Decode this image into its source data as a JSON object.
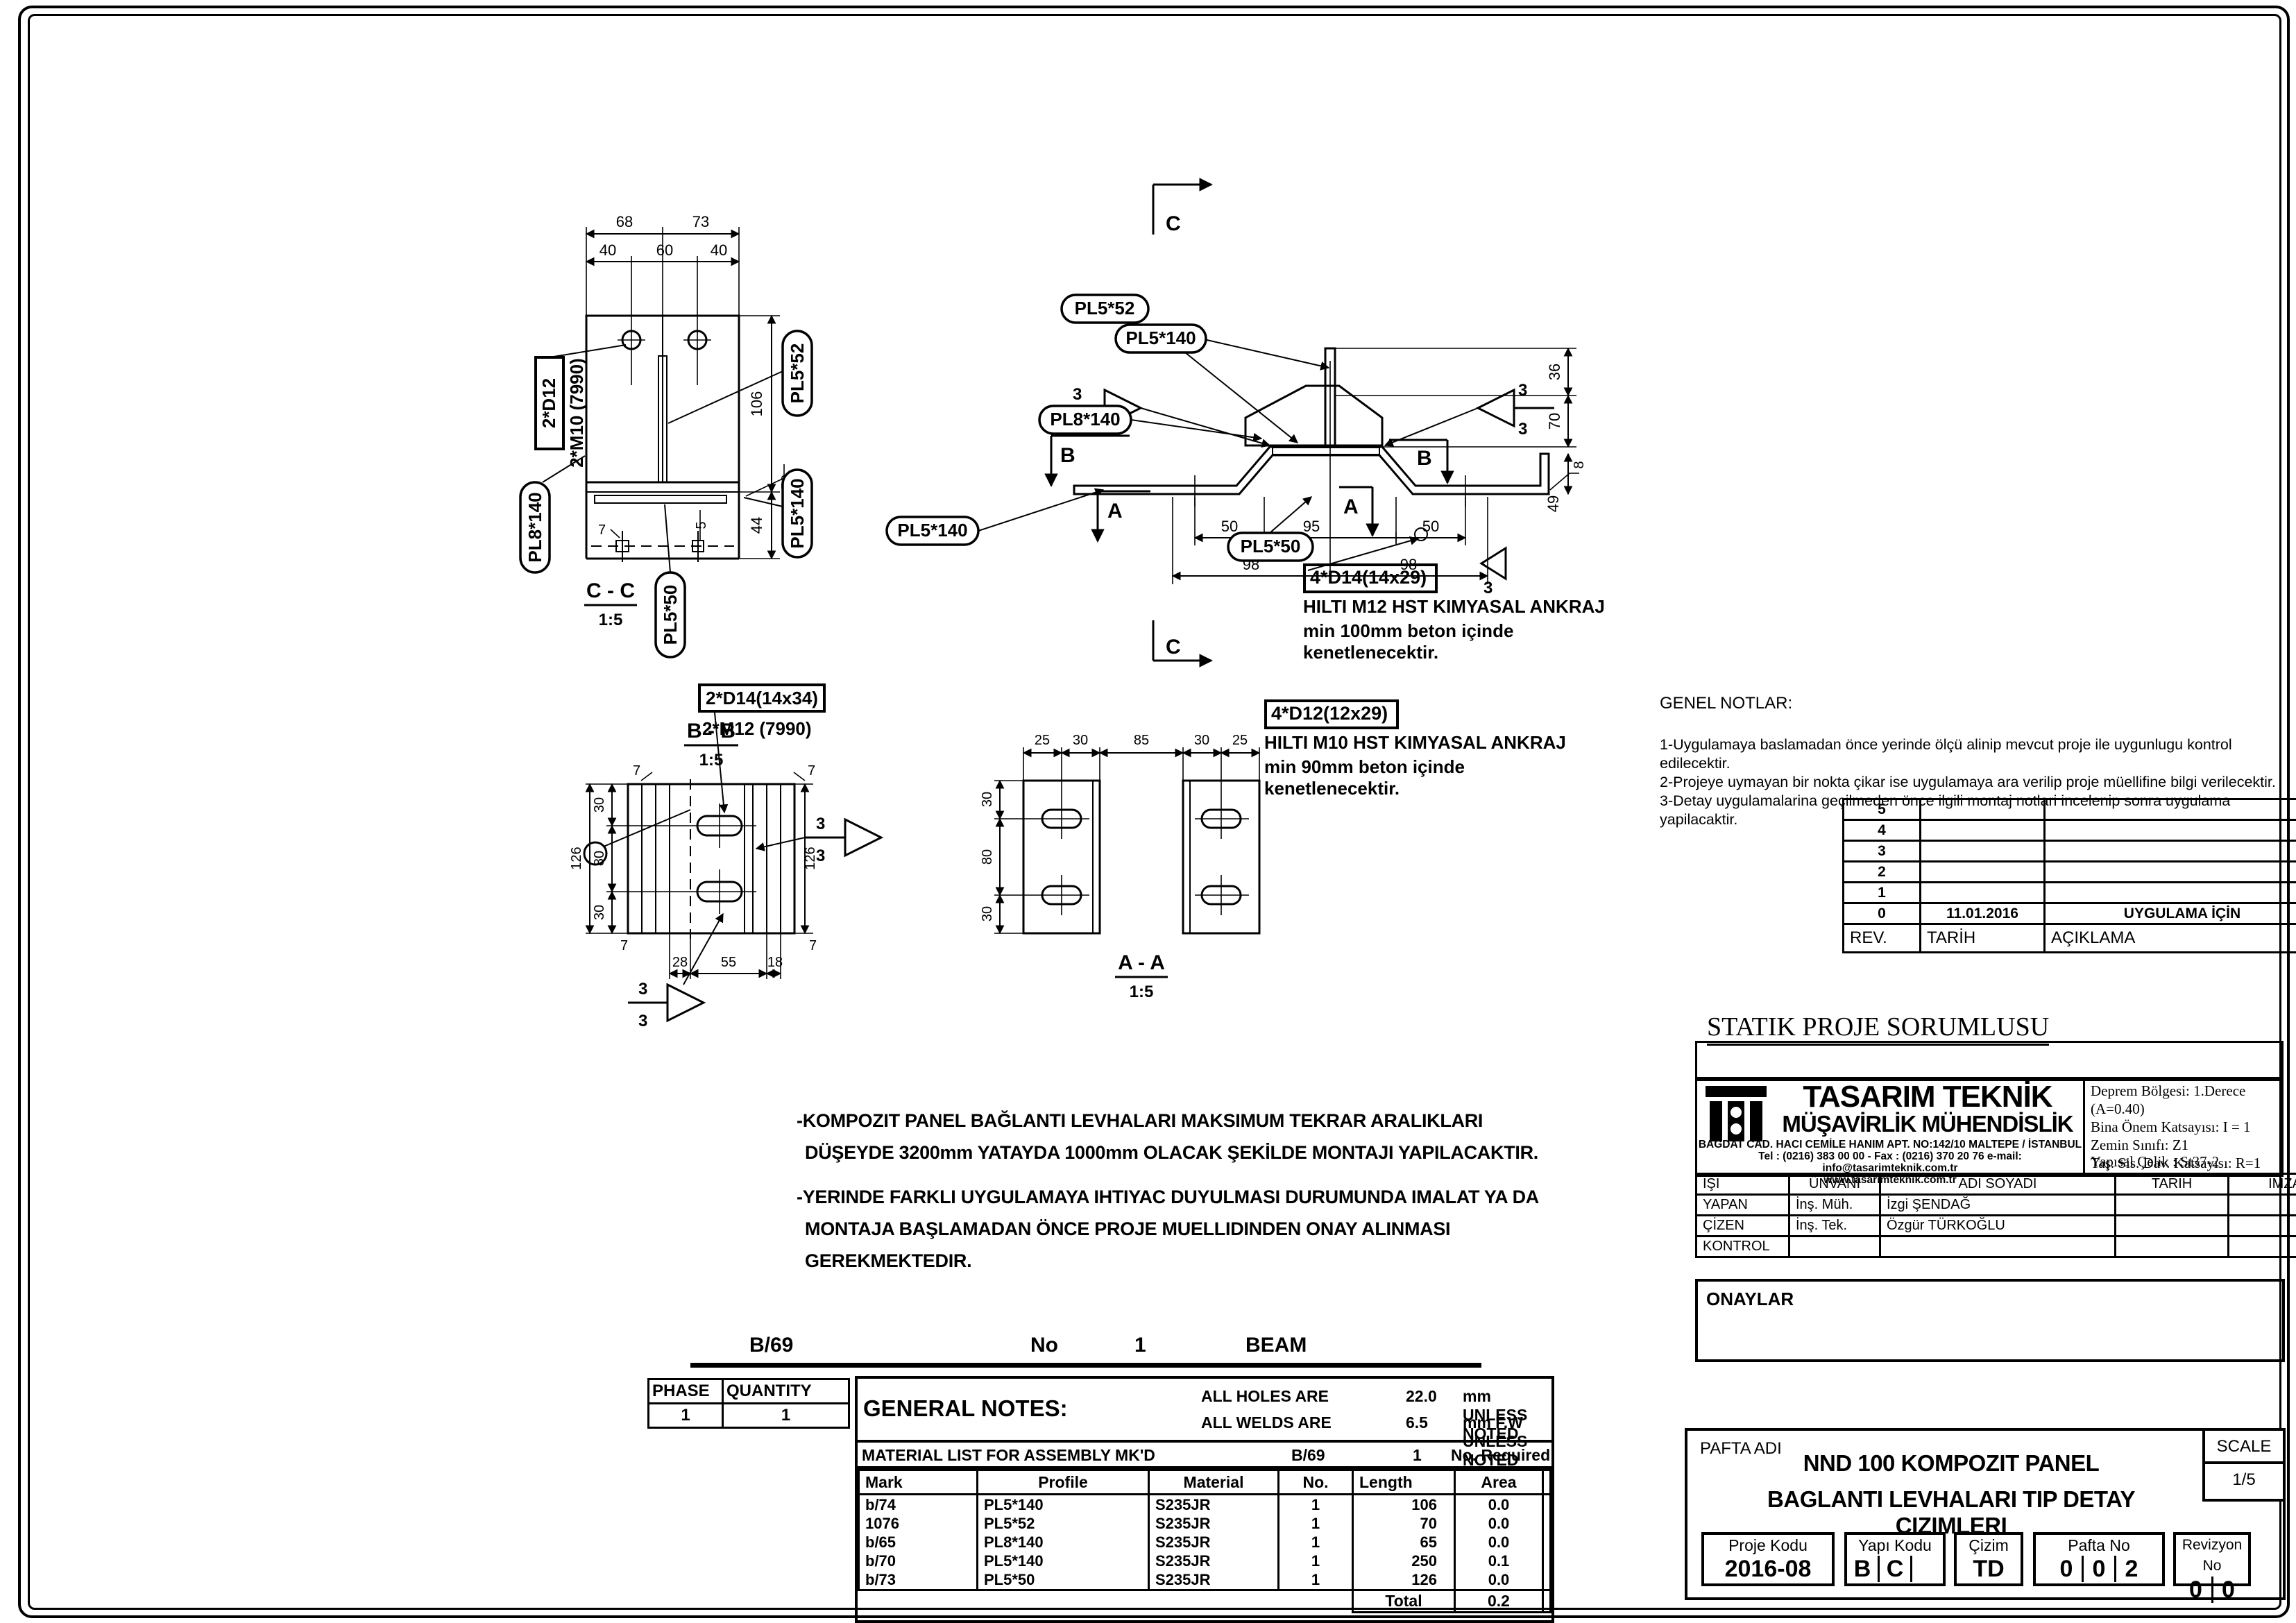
{
  "drawings": {
    "cc": {
      "title": "C - C",
      "scale": "1:5",
      "labels": {
        "bolt_box": "2*D12",
        "bolt_sub": "2*M10 (7990)",
        "pl552": "PL5*52",
        "pl8140": "PL8*140",
        "pl5140": "PL5*140",
        "pl550": "PL5*50"
      },
      "dims": {
        "d68": "68",
        "d73": "73",
        "d40a": "40",
        "d60": "60",
        "d40b": "40",
        "d106": "106",
        "d58": "58",
        "d44": "44",
        "d5": "5",
        "d7": "7"
      }
    },
    "elevation": {
      "labels": {
        "pl552": "PL5*52",
        "pl5140_top": "PL5*140",
        "pl8140": "PL8*140",
        "pl5140_left": "PL5*140",
        "pl550": "PL5*50"
      },
      "dims": {
        "d36": "36",
        "d70": "70",
        "d8": "8",
        "d49": "49",
        "d50a": "50",
        "d95": "95",
        "d50b": "50",
        "d98a": "98",
        "d98b": "98"
      },
      "weld": "3",
      "sections": {
        "c": "C",
        "b": "B",
        "a": "A"
      },
      "anchor": {
        "box": "4*D14(14x29)",
        "line1": "HILTI M12 HST KIMYASAL ANKRAJ",
        "line2": "min 100mm beton içinde kenetlenecektir."
      }
    },
    "bb": {
      "title": "B - B",
      "scale": "1:5",
      "label_box": "2*D14(14x34)",
      "label_sub": "2*M12 (7990)",
      "weld": "3",
      "dims": {
        "d7a": "7",
        "d7b": "7",
        "d7c": "7",
        "d7d": "7",
        "d30a": "30",
        "d80": "80",
        "d30b": "30",
        "d126a": "126",
        "d126b": "126",
        "d28": "28",
        "d55": "55",
        "d18": "18"
      }
    },
    "aa": {
      "title": "A - A",
      "scale": "1:5",
      "dims": {
        "d25a": "25",
        "d30a": "30",
        "d85": "85",
        "d30b": "30",
        "d25b": "25",
        "v30a": "30",
        "v80": "80",
        "v30b": "30"
      },
      "anchor": {
        "box": "4*D12(12x29)",
        "line1": "HILTI M10 HST KIMYASAL ANKRAJ",
        "line2": "min 90mm beton içinde kenetlenecektir."
      }
    }
  },
  "montaj_notes": {
    "p1l1": "-KOMPOZIT PANEL BAĞLANTI  LEVHALARI MAKSIMUM TEKRAR ARALIKLARI",
    "p1l2": "DÜŞEYDE 3200mm YATAYDA 1000mm OLACAK ŞEKİLDE MONTAJI YAPILACAKTIR.",
    "p2l1": "-YERINDE FARKLI UYGULAMAYA IHTIYAC DUYULMASI DURUMUNDA IMALAT YA DA",
    "p2l2": "MONTAJA BAŞLAMADAN ÖNCE PROJE MUELLIDINDEN ONAY ALINMASI GEREKMEKTEDIR."
  },
  "genel_notlar": {
    "title": "GENEL NOTLAR:",
    "items": [
      "1-Uygulamaya baslamadan önce yerinde ölçü alinip mevcut proje ile uygunlugu kontrol edilecektir.",
      "2-Projeye uymayan bir  nokta çikar ise uygulamaya ara verilip proje müellifine bilgi verilecektir.",
      "3-Detay uygulamalarina geçilmeden önce ilgili montaj notlari incelenip sonra uygulama yapilacaktir."
    ]
  },
  "revision": {
    "headers": [
      "REV.",
      "TARİH",
      "AÇIKLAMA"
    ],
    "rows": [
      [
        "5",
        "",
        ""
      ],
      [
        "4",
        "",
        ""
      ],
      [
        "3",
        "",
        ""
      ],
      [
        "2",
        "",
        ""
      ],
      [
        "1",
        "",
        ""
      ],
      [
        "0",
        "11.01.2016",
        "UYGULAMA İÇİN"
      ]
    ]
  },
  "statik_title": "STATIK PROJE SORUMLUSU",
  "company": {
    "name1": "TASARIM TEKNİK",
    "name2": "MÜŞAVİRLİK MÜHENDİSLİK",
    "address": "BAĞDAT CAD. HACI CEMİLE HANIM APT. NO:142/10   MALTEPE / İSTANBUL",
    "tel": "Tel : (0216) 383 00 00 - Fax : (0216) 370 20 76  e-mail: info@tasarimteknik.com.tr",
    "web": "www.tasarimteknik.com.tr"
  },
  "seismic": {
    "l1": "Deprem Bölgesi: 1.Derece (A=0.40)",
    "l2": "Bina Önem Katsayısı: I = 1",
    "l3": "Zemin Sınıfı: Z1",
    "l4": "Taş. Sis. Dav. Katsayısı: R=1",
    "l5": "Yapısal Çelik : St37-2"
  },
  "sign_table": {
    "headers": [
      "İŞİ",
      "ÜNVANI",
      "ADI SOYADI",
      "TARİH",
      "İMZA"
    ],
    "rows": [
      [
        "YAPAN",
        "İnş. Müh.",
        "İzgi ŞENDAĞ",
        "",
        ""
      ],
      [
        "ÇİZEN",
        "İnş. Tek.",
        "Özgür TÜRKOĞLU",
        "",
        ""
      ],
      [
        "KONTROL",
        "",
        "",
        "",
        ""
      ]
    ]
  },
  "onaylar": "ONAYLAR",
  "pafta": {
    "label": "PAFTA ADI",
    "title1": "NND 100 KOMPOZIT PANEL",
    "title2": "BAGLANTI LEVHALARI TIP DETAY CIZIMLERI",
    "scale_label": "SCALE",
    "scale_value": "1/5",
    "proje_kodu": {
      "label": "Proje Kodu",
      "value": "2016-08"
    },
    "yapi_kodu": {
      "label": "Yapı Kodu",
      "c1": "B",
      "c2": "C",
      "c3": ""
    },
    "cizim": {
      "label": "Çizim",
      "value": "TD"
    },
    "pafta_no": {
      "label": "Pafta No",
      "c1": "0",
      "c2": "0",
      "c3": "2"
    },
    "revizyon_no": {
      "label": "Revizyon No",
      "c1": "0",
      "c2": "0"
    }
  },
  "assembly": {
    "mark": "B/69",
    "no_label": "No",
    "no_value": "1",
    "type": "BEAM"
  },
  "phase_table": {
    "h1": "PHASE",
    "h2": "QUANTITY",
    "v1": "1",
    "v2": "1"
  },
  "general_notes": {
    "title": "GENERAL NOTES:",
    "holes_label": "ALL HOLES ARE",
    "holes_value": "22.0",
    "holes_unit": "mm UNLESS NOTED",
    "welds_label": "ALL WELDS ARE",
    "welds_value": "6.5",
    "welds_unit": "mm F.W UNLESS NOTED"
  },
  "material_list": {
    "caption": "MATERIAL LIST FOR ASSEMBLY MK'D",
    "assembly": "B/69",
    "req_value": "1",
    "req_label": "No. Required",
    "headers": [
      "Mark",
      "Profile",
      "Material",
      "No.",
      "Length",
      "Area",
      "Weight"
    ],
    "rows": [
      [
        "b/74",
        "PL5*140",
        "S235JR",
        "1",
        "106",
        "0.0",
        "0.6"
      ],
      [
        "1076",
        "PL5*52",
        "S235JR",
        "1",
        "70",
        "0.0",
        "0.1"
      ],
      [
        "b/65",
        "PL8*140",
        "S235JR",
        "1",
        "65",
        "0.0",
        "0.6"
      ],
      [
        "b/70",
        "PL5*140",
        "S235JR",
        "1",
        "250",
        "0.1",
        "1.4"
      ],
      [
        "b/73",
        "PL5*50",
        "S235JR",
        "1",
        "126",
        "0.0",
        "0.2"
      ]
    ],
    "total_label": "Total",
    "total_area": "0.2",
    "total_weight": "3.0"
  }
}
